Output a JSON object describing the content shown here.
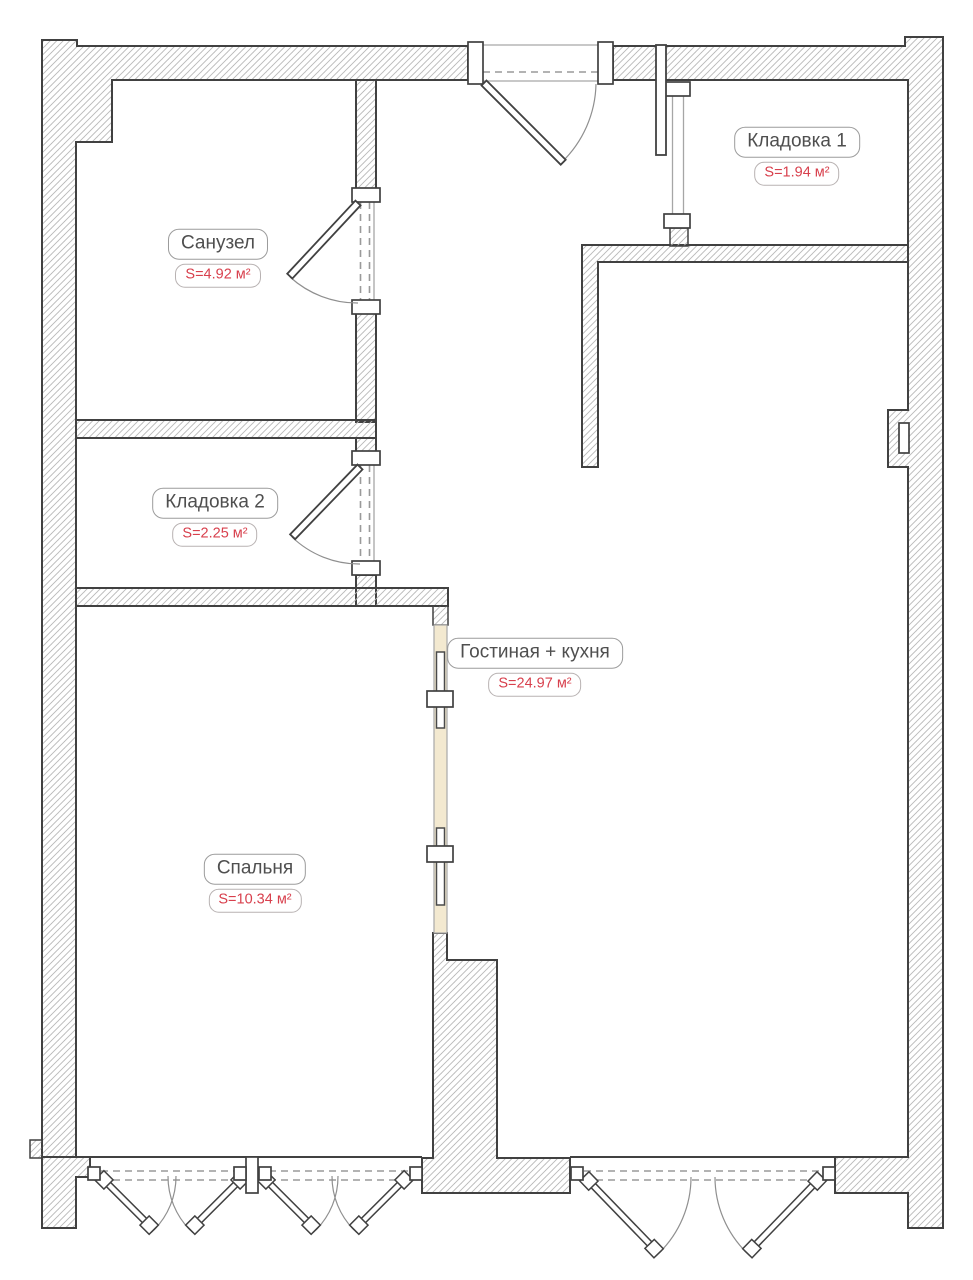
{
  "rooms": [
    {
      "id": "sanuzel",
      "name": "Санузел",
      "area": "S=4.92 м²"
    },
    {
      "id": "kladovka1",
      "name": "Кладовка 1",
      "area": "S=1.94 м²"
    },
    {
      "id": "kladovka2",
      "name": "Кладовка 2",
      "area": "S=2.25 м²"
    },
    {
      "id": "gostinaya",
      "name": "Гостиная + кухня",
      "area": "S=24.97 м²"
    },
    {
      "id": "spalnya",
      "name": "Спальня",
      "area": "S=10.34 м²"
    }
  ],
  "colors": {
    "wall_outline": "#414141",
    "hatch_line": "#b8b8b8",
    "room_name_text": "#4f4f4f",
    "area_text": "#d8404d",
    "label_border": "#9c9c9c",
    "sliding_pocket_fill": "#f3e9d0",
    "background": "#ffffff"
  }
}
